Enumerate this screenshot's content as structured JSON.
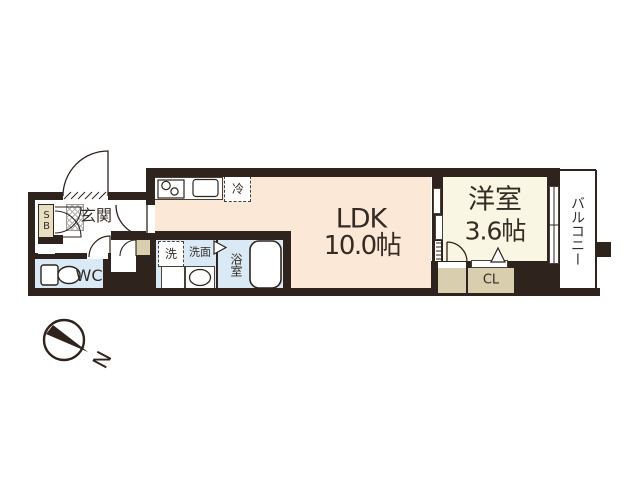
{
  "colors": {
    "wall": "#2f241d",
    "text": "#342c24",
    "ldk_fill": "#fce8d7",
    "western_fill": "#faf6e4",
    "wet_fill": "#d9eaf6",
    "closet_fill": "#d9cfae",
    "shoebox_fill": "#e8dfc2"
  },
  "rooms": {
    "ldk": {
      "label": "LDK",
      "size": "10.0帖"
    },
    "western": {
      "label": "洋室",
      "size": "3.6帖"
    },
    "balcony": {
      "label": "バルコニー"
    },
    "entrance": {
      "label": "玄関"
    },
    "wc": {
      "label": "WC"
    },
    "bath": {
      "label": "浴室"
    },
    "washroom": {
      "label": "洗面"
    },
    "shoebox": {
      "label": "SB"
    },
    "closet": {
      "label": "CL"
    }
  },
  "fixtures": {
    "washer": {
      "label": "洗"
    },
    "refrigerator": {
      "label": "冷"
    }
  },
  "compass": {
    "north": "N"
  }
}
